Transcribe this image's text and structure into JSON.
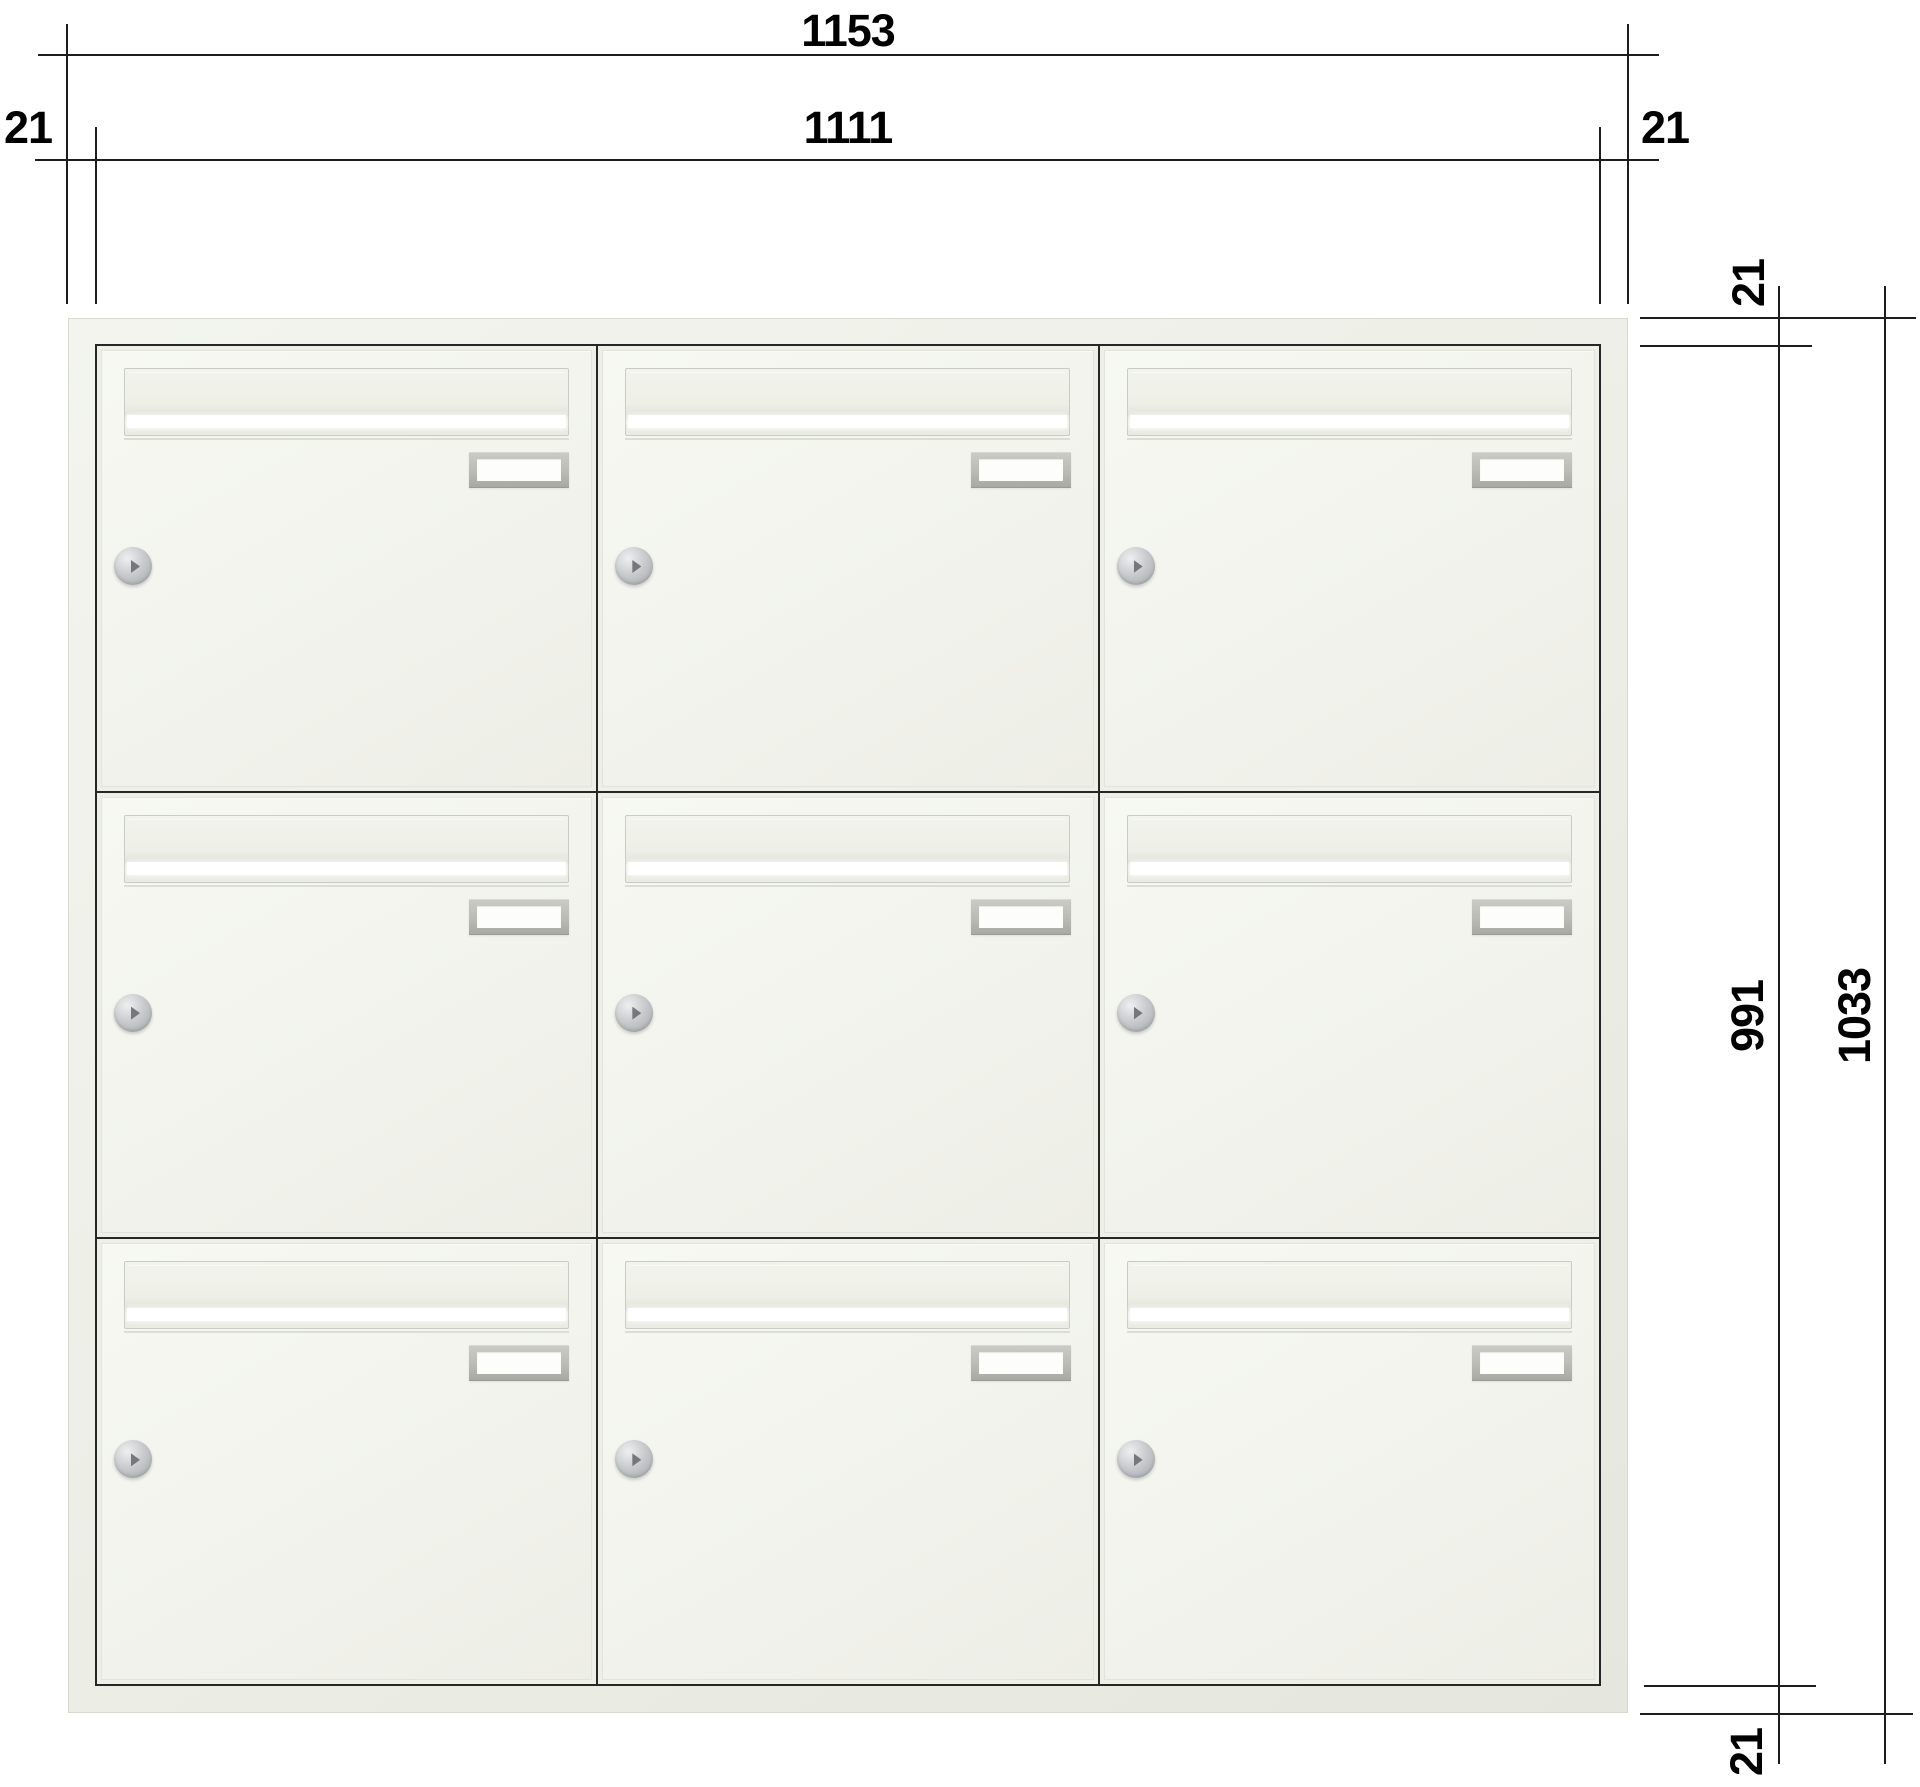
{
  "dimensions": {
    "overall_width": "1153",
    "inner_width": "1111",
    "margin_left": "21",
    "margin_right": "21",
    "margin_top": "21",
    "inner_height": "991",
    "overall_height": "1033",
    "margin_bottom": "21"
  },
  "cabinet": {
    "rows": 3,
    "columns": 3,
    "compartment_count": 9,
    "door_features": [
      "letter-flap",
      "letter-slot",
      "name-plate",
      "lock-cylinder"
    ]
  },
  "colors": {
    "background": "#ffffff",
    "line": "#1d1d1d",
    "frame_fill": "#eceee6",
    "door_fill": "#f3f4ee",
    "slot_highlight": "#ffffff",
    "plate_frame": "#b9bbb4",
    "lock_silver": "#c9cbce"
  }
}
